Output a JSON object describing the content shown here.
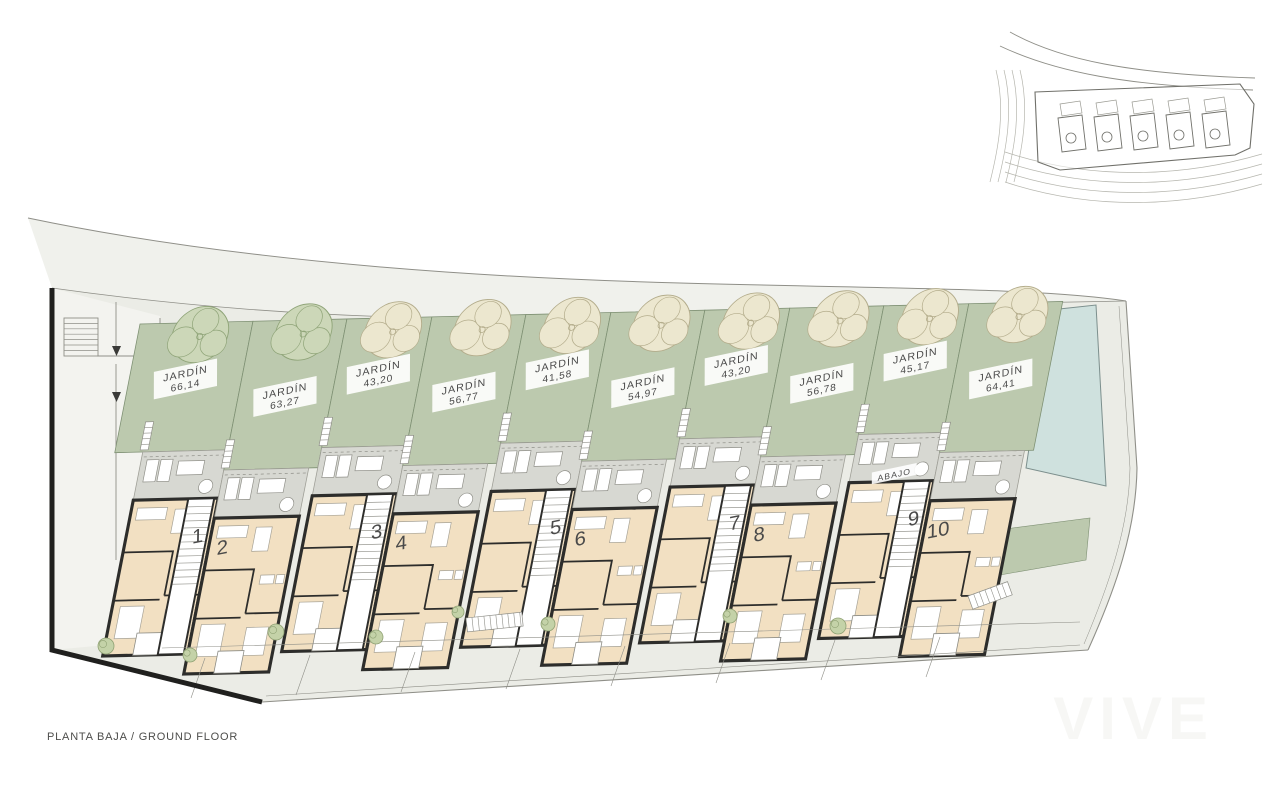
{
  "footer": {
    "title": "PLANTA BAJA / GROUND FLOOR"
  },
  "watermark": {
    "text": "VIVE"
  },
  "plan": {
    "gardens": [
      {
        "unit": "1",
        "label": "JARDÍN",
        "area": "66,14"
      },
      {
        "unit": "2",
        "label": "JARDÍN",
        "area": "63,27"
      },
      {
        "unit": "3",
        "label": "JARDÍN",
        "area": "43,20"
      },
      {
        "unit": "4",
        "label": "JARDÍN",
        "area": "56,77"
      },
      {
        "unit": "5",
        "label": "JARDÍN",
        "area": "41,58"
      },
      {
        "unit": "6",
        "label": "JARDÍN",
        "area": "54,97"
      },
      {
        "unit": "7",
        "label": "JARDÍN",
        "area": "43,20"
      },
      {
        "unit": "8",
        "label": "JARDÍN",
        "area": "56,78"
      },
      {
        "unit": "9",
        "label": "JARDÍN",
        "area": "45,17"
      },
      {
        "unit": "10",
        "label": "JARDÍN",
        "area": "64,41"
      }
    ],
    "blocks": [
      {
        "units": [
          "1",
          "2"
        ]
      },
      {
        "units": [
          "3",
          "4"
        ]
      },
      {
        "units": [
          "5",
          "6"
        ]
      },
      {
        "units": [
          "7",
          "8"
        ]
      },
      {
        "units": [
          "9",
          "10"
        ]
      }
    ],
    "annotations": {
      "abajo": "ABAJO"
    }
  },
  "colors": {
    "site": "#ebece6",
    "walkway": "#f3f3ef",
    "road": "#f0f1ec",
    "garden": "#bcc9ae",
    "garden_stroke": "#7e9073",
    "terrace": "#d7d8d2",
    "terrace_stroke": "#9e9e96",
    "interior": "#f2e0c2",
    "wall": "#2d2d2b",
    "pool": "#cfe1de",
    "pool_stroke": "#7c8f8d",
    "tree_cream": "#ece7cf",
    "tree_cream_stroke": "#b3ac8b",
    "tree_green": "#ccd7b8",
    "tree_green_stroke": "#8fa478",
    "bush": "#c4d2a8",
    "bush_stroke": "#8fa173",
    "line": "#8f8f88",
    "boundary": "#20201e",
    "text": "#4a4a4a",
    "label_bg": "#ffffff"
  }
}
